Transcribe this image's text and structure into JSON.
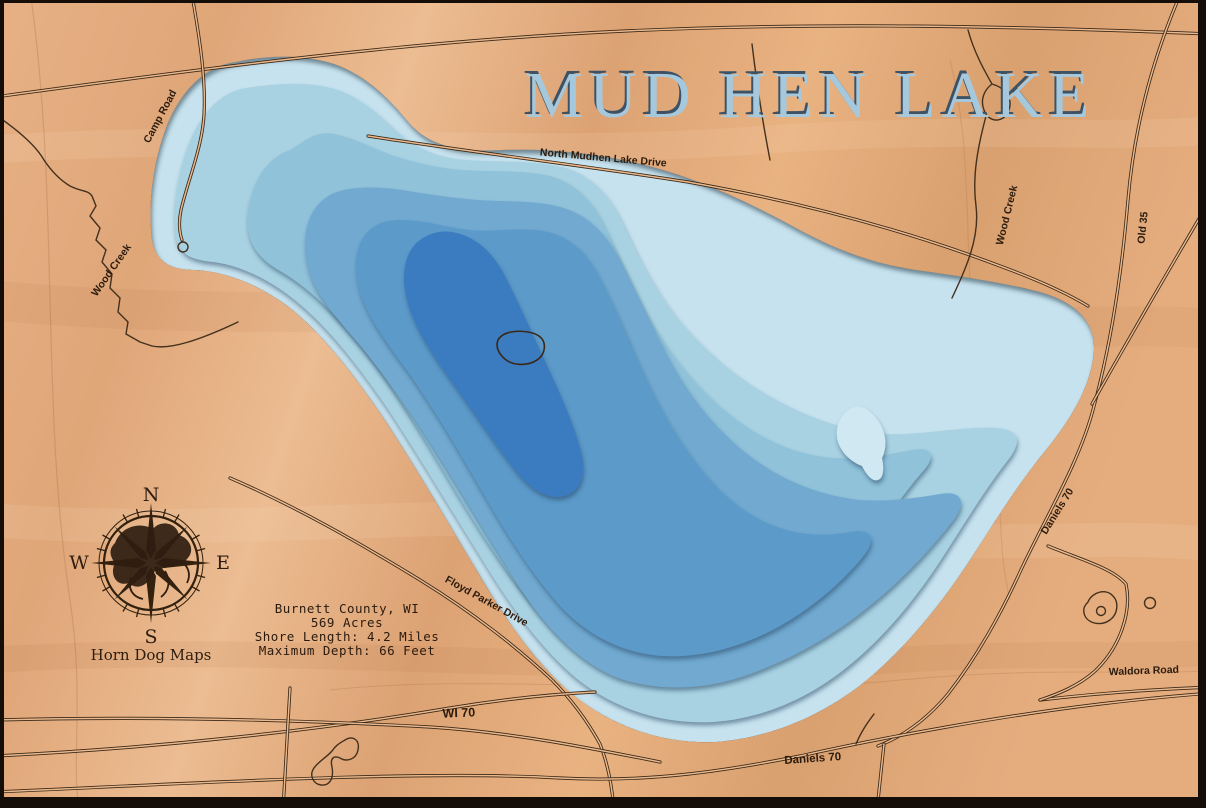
{
  "map": {
    "title": "MUD HEN LAKE",
    "info": {
      "county": "Burnett County, WI",
      "acres": "569 Acres",
      "shore": "Shore Length:  4.2 Miles",
      "depth": "Maximum Depth:  66 Feet"
    },
    "brand": "Horn Dog Maps",
    "compass": {
      "n": "N",
      "e": "E",
      "s": "S",
      "w": "W"
    },
    "labels": {
      "north_mudhen": "North Mudhen Lake Drive",
      "camp": "Camp Road",
      "wood_creek_w": "Wood Creek",
      "wood_creek_e": "Wood Creek",
      "old35": "Old 35",
      "daniels_e": "Daniels 70",
      "floyd": "Floyd Parker Drive",
      "wi70": "WI 70",
      "waldora": "Waldora Road",
      "daniels_s": "Daniels 70"
    },
    "colors": {
      "wood": "#e3a97c",
      "depth1": "#c6e2ee",
      "depth2": "#a8d2e2",
      "depth3": "#90c2da",
      "depth4": "#71a9d0",
      "depth5": "#5c9aca",
      "depth6": "#3b7cc1",
      "shallow_hump": "#cfe8f2",
      "engrave": "#3a2817",
      "title": "#a6c8dc"
    }
  }
}
